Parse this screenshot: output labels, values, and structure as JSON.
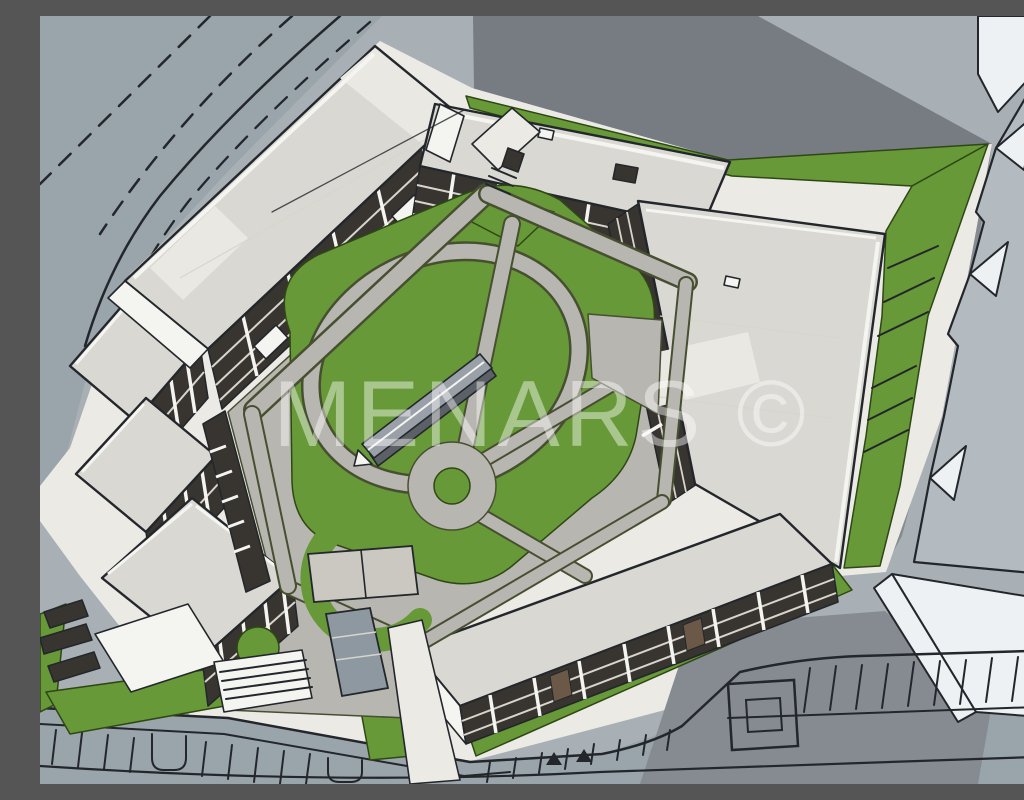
{
  "watermark": {
    "text": "MENARS ©"
  },
  "scene": {
    "alt": "Aerial 3D massing render of a perimeter apartment block with a landscaped inner courtyard, loop footpaths, roundabout path circle, garage ramps, surrounding roads with lane markings, street parking rows, and gray context building slabs to the right"
  },
  "palette": {
    "ground": "#a9b0b5",
    "road": "#9aa4ab",
    "shadow": "#767c82",
    "shadow2": "#858b91",
    "sidewalk": "#eceae5",
    "roof": "#d9d8d2",
    "roofLight": "#e9e8e3",
    "white": "#f4f4f1",
    "facade": "#383530",
    "floorLine": "#d8d5cd",
    "grass": "#679938",
    "grassEdge": "#2f4715",
    "path": "#b8b6b0",
    "pathEdge": "#474f31",
    "ink": "#23272c",
    "ramp": "#99a0a8",
    "rampSide": "#5c6167",
    "ctxTop": "#b3bac0",
    "ctxFace": "#edf1f3",
    "doors": "#6b5846",
    "garage": "#8e98a1",
    "watermark": "rgba(255,255,255,0.44)"
  }
}
